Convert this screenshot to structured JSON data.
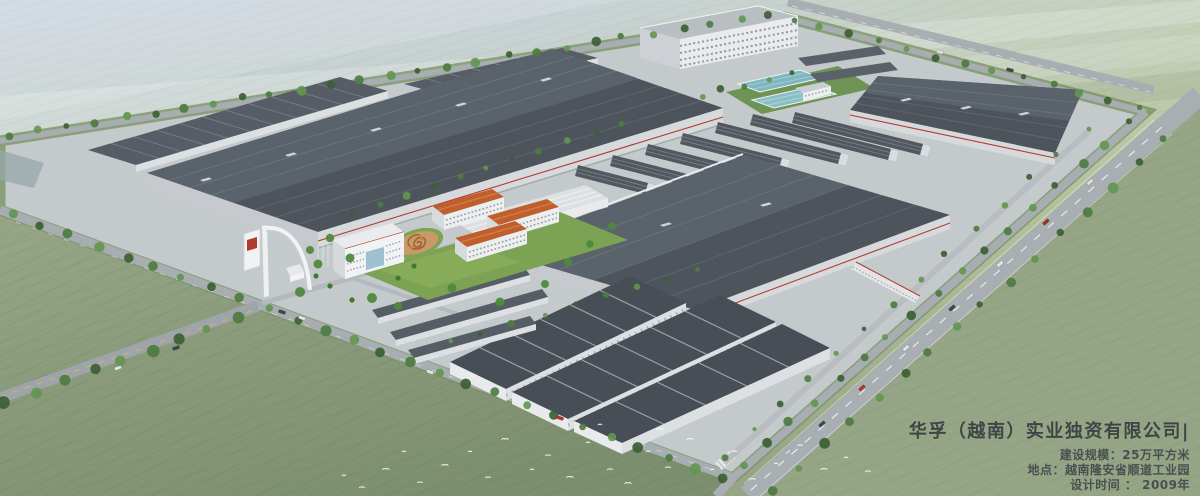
{
  "caption": {
    "company_title": "华孚（越南）实业独资有限公司|",
    "details": [
      "建设规模：25万平方米",
      "地点：越南隆安省顺道工业园",
      "设计时间 ： 2009年"
    ]
  },
  "colors": {
    "haze_blue": "#ccd6e2",
    "field_green_light": "#b7c2a4",
    "field_green": "#93a383",
    "field_green_dark": "#7e9170",
    "roof_slate_dark": "#4d545c",
    "roof_slate_light": "#5a626b",
    "wall_white": "#e3e5e7",
    "accent_red": "#b23b30",
    "roof_terracotta": "#bf5f2d",
    "pool_teal": "#7fb6bf",
    "tree_green": "#4e7b40",
    "road_gray": "#a8adb2",
    "lawn_green": "#7ca254",
    "caption_text": "#3f444a"
  }
}
